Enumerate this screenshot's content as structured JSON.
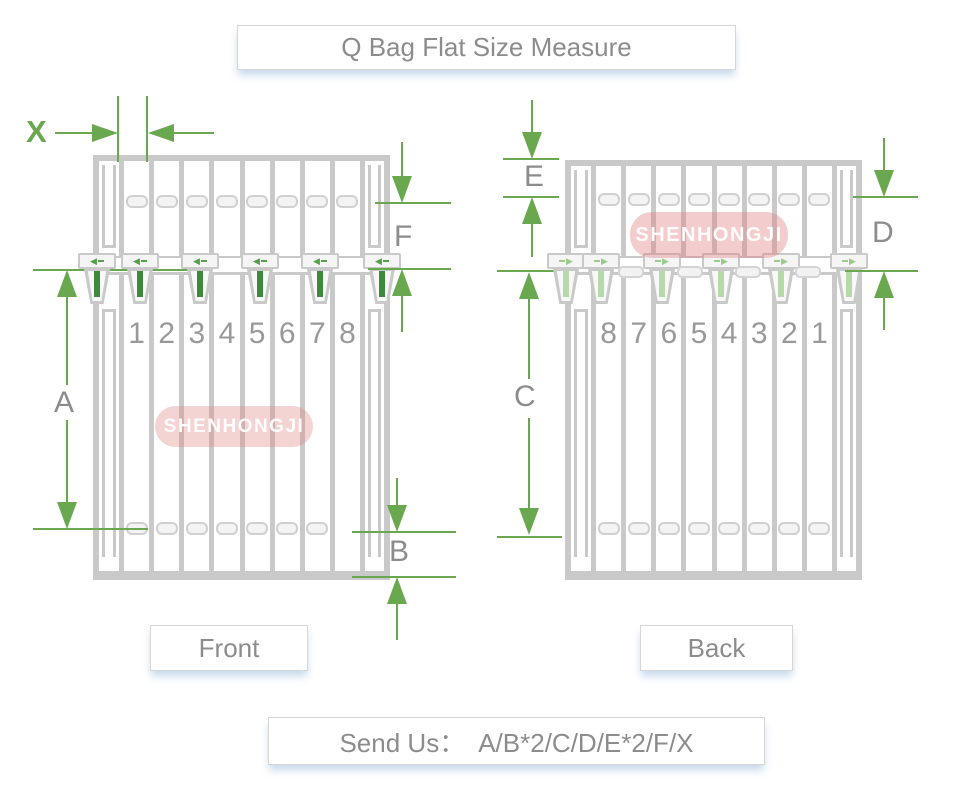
{
  "title": "Q Bag Flat Size Measure",
  "front": {
    "label": "Front",
    "watermark": "SHENHONGJI",
    "slot_numbers": [
      "1",
      "2",
      "3",
      "4",
      "5",
      "6",
      "7",
      "8"
    ]
  },
  "back": {
    "label": "Back",
    "watermark": "SHENHONGJI",
    "slot_numbers": [
      "8",
      "7",
      "6",
      "5",
      "4",
      "3",
      "2",
      "1"
    ]
  },
  "dimensions": {
    "x": "X",
    "a": "A",
    "b": "B",
    "c": "C",
    "d": "D",
    "e": "E",
    "f": "F"
  },
  "footer": {
    "send_us": "Send Us：  A/B*2/C/D/E*2/F/X"
  },
  "icons": {
    "clip_arrow_left": "◀",
    "clip_arrow_right": "▶"
  },
  "colors": {
    "dimension_green": "#6aa84f",
    "outline_gray": "#c9c9c9",
    "text_gray": "#8c8c8c",
    "watermark_pink": "#e08282"
  }
}
